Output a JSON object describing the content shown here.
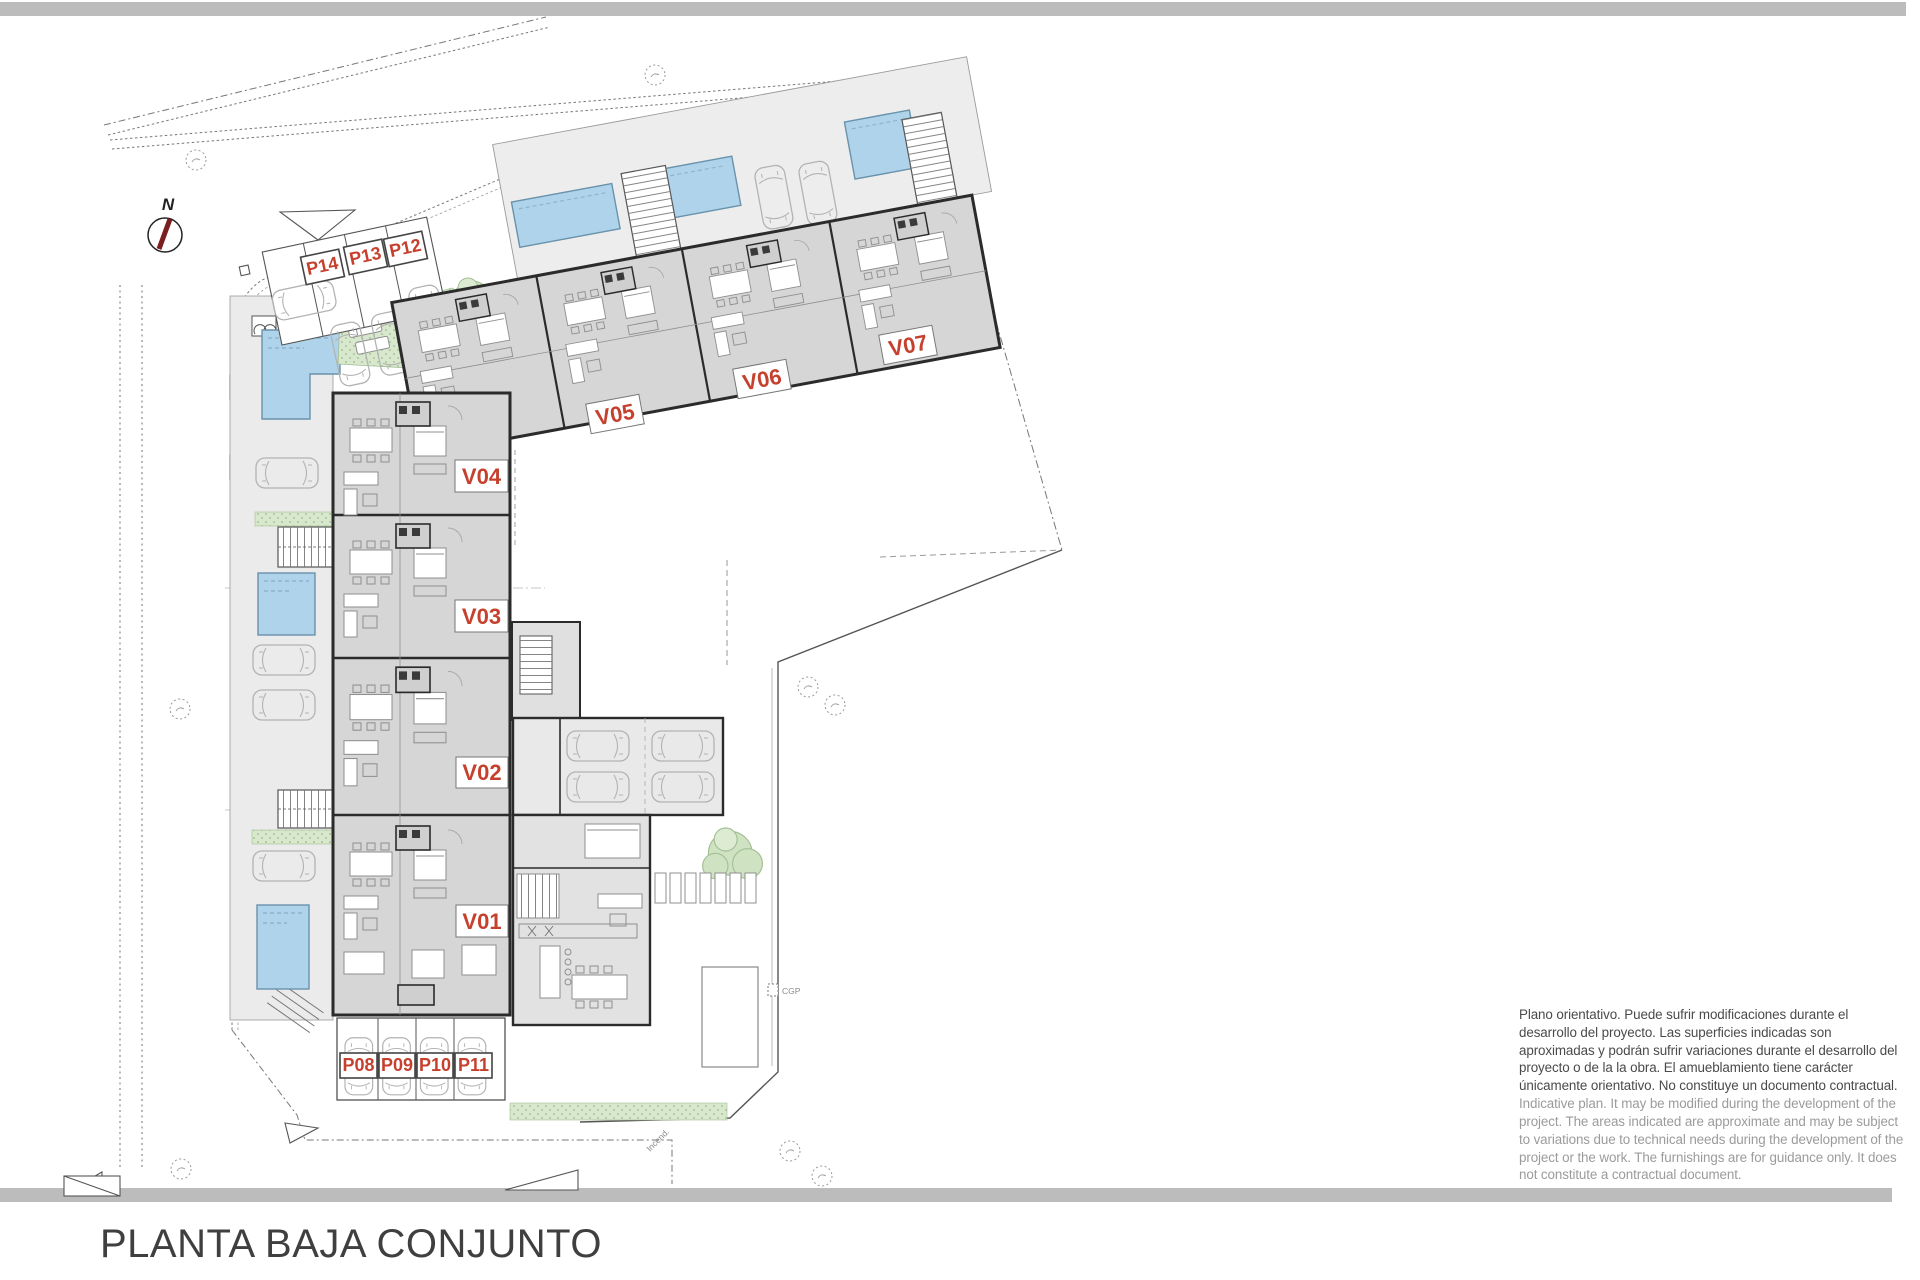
{
  "title": "PLANTA BAJA CONJUNTO",
  "compass": {
    "north": "N"
  },
  "labels": {
    "units": {
      "v01": "V01",
      "v02": "V02",
      "v03": "V03",
      "v04": "V04",
      "v05": "V05",
      "v06": "V06",
      "v07": "V07"
    },
    "parking": {
      "p08": "P08",
      "p09": "P09",
      "p10": "P10",
      "p11": "P11",
      "p12": "P12",
      "p13": "P13",
      "p14": "P14"
    }
  },
  "annotations": {
    "cgp": "CGP",
    "incend": "Incend."
  },
  "disclaimer": {
    "es": "Plano orientativo. Puede sufrir modificaciones durante el desarrollo del proyecto. Las superficies indicadas son aproximadas y podrán sufrir variaciones durante el desarrollo del proyecto o de la la obra. El amueblamiento tiene carácter únicamente orientativo. No constituye un documento contractual.",
    "en": "Indicative plan. It may be modified during the development of the project. The areas indicated are approximate and may be subject to variations due to technical needs during the development of the project or the work. The furnishings are for guidance only. It does not constitute a contractual document."
  },
  "colors": {
    "accent_red": "#C6402E",
    "pool_blue": "#AED3EA",
    "green": "#D7E8CC",
    "wall_dark": "#2B2B2B",
    "room_gray": "#D6D6D6",
    "terrace_gray": "#EDEDED",
    "bar_gray": "#BCBCBC"
  }
}
